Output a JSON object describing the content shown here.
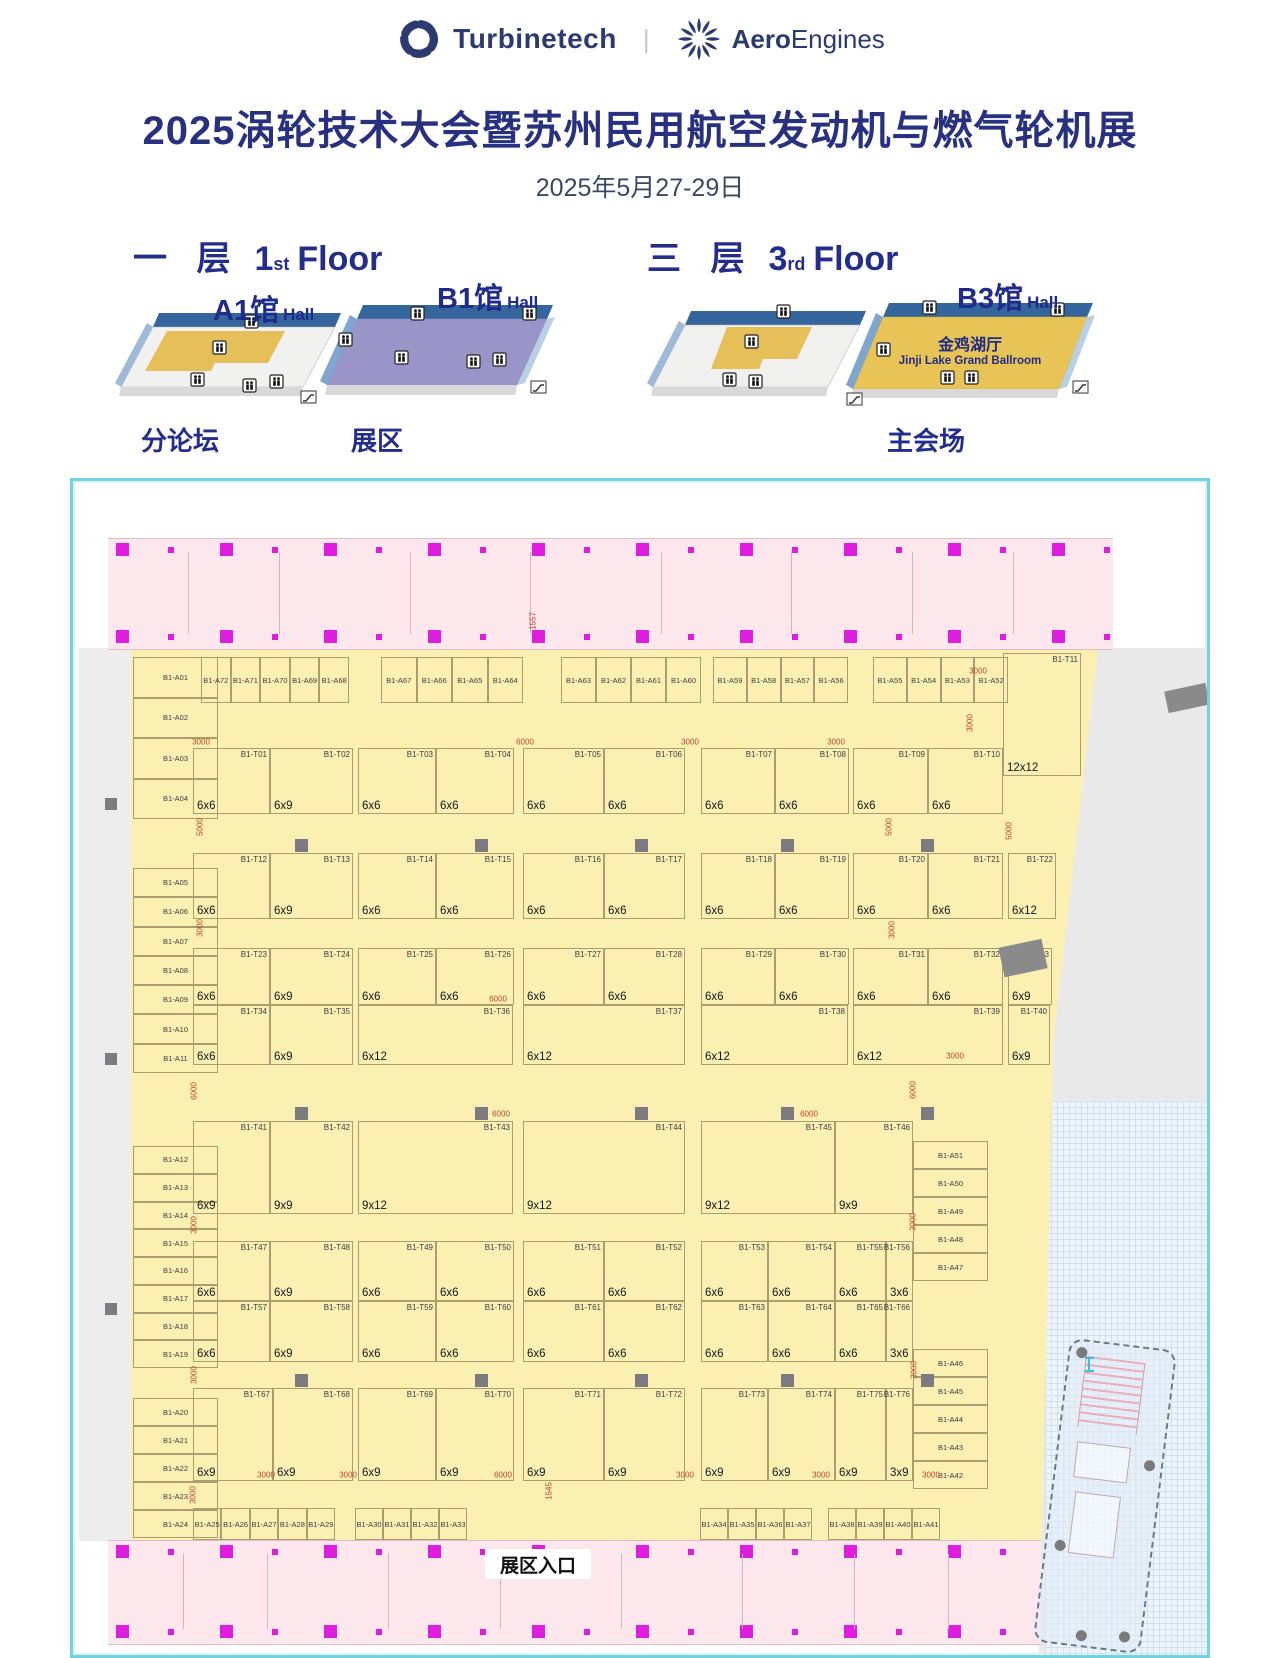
{
  "header": {
    "brand1": "Turbinetech",
    "divider": "|",
    "brand2_bold": "Aero",
    "brand2_rest": "Engines"
  },
  "title": "2025涡轮技术大会暨苏州民用航空发动机与燃气轮机展",
  "date": "2025年5月27-29日",
  "floors": {
    "first": {
      "label_zh": "一 层",
      "label_num": "1",
      "label_sup": "st",
      "label_en": "Floor",
      "hall_a": {
        "name": "A1馆",
        "suffix": "Hall"
      },
      "hall_b": {
        "name": "B1馆",
        "suffix": "Hall"
      },
      "caption_a": "分论坛",
      "caption_b": "展区"
    },
    "third": {
      "label_zh": "三 层",
      "label_num": "3",
      "label_sup": "rd",
      "label_en": "Floor",
      "hall": {
        "name": "B3馆",
        "suffix": "Hall"
      },
      "ballroom_zh": "金鸡湖厅",
      "ballroom_en": "Jinji Lake Grand Ballroom",
      "caption": "主会场"
    }
  },
  "colors": {
    "navy": "#27317f",
    "floor_yellow": "#faf0b2",
    "pink": "#fbe7ec",
    "magenta": "#df1ddf",
    "cyan": "#73d2e2",
    "gold": "#e6bf58",
    "purple": "#9a95c9",
    "red_dim": "#c0432b"
  },
  "plan": {
    "entrance": "展区入口",
    "left_column_groups": [
      [
        "B1-A01",
        "B1-A02",
        "B1-A03",
        "B1-A04"
      ],
      [
        "B1-A05",
        "B1-A06",
        "B1-A07",
        "B1-A08",
        "B1-A09",
        "B1-A10",
        "B1-A11"
      ],
      [
        "B1-A12",
        "B1-A13",
        "B1-A14",
        "B1-A15",
        "B1-A16",
        "B1-A17",
        "B1-A18",
        "B1-A19"
      ],
      [
        "B1-A20",
        "B1-A21",
        "B1-A22",
        "B1-A23",
        "B1-A24"
      ]
    ],
    "top_row_groups": [
      [
        "B1-A72",
        "B1-A71",
        "B1-A70",
        "B1-A69",
        "B1-A68"
      ],
      [
        "B1-A67",
        "B1-A66",
        "B1-A65",
        "B1-A64"
      ],
      [
        "B1-A63",
        "B1-A62",
        "B1-A61",
        "B1-A60"
      ],
      [
        "B1-A59",
        "B1-A58",
        "B1-A57",
        "B1-A56"
      ],
      [
        "B1-A55",
        "B1-A54",
        "B1-A53",
        "B1-A52"
      ]
    ],
    "right_column_groups": [
      [
        "B1-A51",
        "B1-A50",
        "B1-A49",
        "B1-A48",
        "B1-A47"
      ],
      [
        "B1-A46",
        "B1-A45",
        "B1-A44",
        "B1-A43",
        "B1-A42"
      ]
    ],
    "bottom_row_groups": [
      [
        "B1-A25",
        "B1-A26",
        "B1-A27",
        "B1-A28",
        "B1-A29"
      ],
      [
        "B1-A30",
        "B1-A31",
        "B1-A32",
        "B1-A33"
      ],
      [
        "B1-A34",
        "B1-A35",
        "B1-A36",
        "B1-A37"
      ],
      [
        "B1-A38",
        "B1-A39",
        "B1-A40",
        "B1-A41"
      ]
    ],
    "right_booths": [
      {
        "id": "B1-T11",
        "size": "12x12"
      },
      {
        "id": "B1-T22",
        "size": "6x12"
      },
      {
        "id": "B1-T33",
        "size": "6x9"
      },
      {
        "id": "B1-T40",
        "size": "6x9"
      }
    ],
    "bands": [
      {
        "blocks": [
          [
            {
              "id": "B1-T01",
              "size": "6x6",
              "w": 0.48
            },
            {
              "id": "B1-T02",
              "size": "6x9",
              "w": 0.52
            }
          ],
          [
            {
              "id": "B1-T03",
              "size": "6x6",
              "w": 0.5
            },
            {
              "id": "B1-T04",
              "size": "6x6",
              "w": 0.5
            }
          ],
          [
            {
              "id": "B1-T05",
              "size": "6x6",
              "w": 0.5
            },
            {
              "id": "B1-T06",
              "size": "6x6",
              "w": 0.5
            }
          ],
          [
            {
              "id": "B1-T07",
              "size": "6x6",
              "w": 0.5
            },
            {
              "id": "B1-T08",
              "size": "6x6",
              "w": 0.5
            }
          ],
          [
            {
              "id": "B1-T09",
              "size": "6x6",
              "w": 0.5
            },
            {
              "id": "B1-T10",
              "size": "6x6",
              "w": 0.5
            }
          ]
        ]
      },
      {
        "blocks": [
          [
            {
              "id": "B1-T12",
              "size": "6x6",
              "w": 0.48
            },
            {
              "id": "B1-T13",
              "size": "6x9",
              "w": 0.52
            }
          ],
          [
            {
              "id": "B1-T14",
              "size": "6x6",
              "w": 0.5
            },
            {
              "id": "B1-T15",
              "size": "6x6",
              "w": 0.5
            }
          ],
          [
            {
              "id": "B1-T16",
              "size": "6x6",
              "w": 0.5
            },
            {
              "id": "B1-T17",
              "size": "6x6",
              "w": 0.5
            }
          ],
          [
            {
              "id": "B1-T18",
              "size": "6x6",
              "w": 0.5
            },
            {
              "id": "B1-T19",
              "size": "6x6",
              "w": 0.5
            }
          ],
          [
            {
              "id": "B1-T20",
              "size": "6x6",
              "w": 0.5
            },
            {
              "id": "B1-T21",
              "size": "6x6",
              "w": 0.5
            }
          ]
        ]
      },
      {
        "blocks": [
          [
            {
              "id": "B1-T23",
              "size": "6x6",
              "w": 0.48
            },
            {
              "id": "B1-T24",
              "size": "6x9",
              "w": 0.52
            }
          ],
          [
            {
              "id": "B1-T25",
              "size": "6x6",
              "w": 0.5
            },
            {
              "id": "B1-T26",
              "size": "6x6",
              "w": 0.5
            }
          ],
          [
            {
              "id": "B1-T27",
              "size": "6x6",
              "w": 0.5
            },
            {
              "id": "B1-T28",
              "size": "6x6",
              "w": 0.5
            }
          ],
          [
            {
              "id": "B1-T29",
              "size": "6x6",
              "w": 0.5
            },
            {
              "id": "B1-T30",
              "size": "6x6",
              "w": 0.5
            }
          ],
          [
            {
              "id": "B1-T31",
              "size": "6x6",
              "w": 0.5
            },
            {
              "id": "B1-T32",
              "size": "6x6",
              "w": 0.5
            }
          ]
        ]
      },
      {
        "blocks": [
          [
            {
              "id": "B1-T34",
              "size": "6x6",
              "w": 0.48
            },
            {
              "id": "B1-T35",
              "size": "6x9",
              "w": 0.52
            }
          ],
          [
            {
              "id": "B1-T36",
              "size": "6x12",
              "w": 1
            }
          ],
          [
            {
              "id": "B1-T37",
              "size": "6x12",
              "w": 1
            }
          ],
          [
            {
              "id": "B1-T38",
              "size": "6x12",
              "w": 1
            }
          ],
          [
            {
              "id": "B1-T39",
              "size": "6x12",
              "w": 1
            }
          ]
        ]
      },
      {
        "blocks": [
          [
            {
              "id": "B1-T41",
              "size": "6x9",
              "w": 0.48
            },
            {
              "id": "B1-T42",
              "size": "9x9",
              "w": 0.52
            }
          ],
          [
            {
              "id": "B1-T43",
              "size": "9x12",
              "w": 1
            }
          ],
          [
            {
              "id": "B1-T44",
              "size": "9x12",
              "w": 1
            }
          ],
          [
            {
              "id": "B1-T45",
              "size": "9x12",
              "w": 1
            }
          ],
          [
            {
              "id": "B1-T46",
              "size": "9x9",
              "w": 1
            }
          ]
        ]
      },
      {
        "blocks": [
          [
            {
              "id": "B1-T47",
              "size": "6x6",
              "w": 0.48
            },
            {
              "id": "B1-T48",
              "size": "6x9",
              "w": 0.52
            }
          ],
          [
            {
              "id": "B1-T49",
              "size": "6x6",
              "w": 0.5
            },
            {
              "id": "B1-T50",
              "size": "6x6",
              "w": 0.5
            }
          ],
          [
            {
              "id": "B1-T51",
              "size": "6x6",
              "w": 0.5
            },
            {
              "id": "B1-T52",
              "size": "6x6",
              "w": 0.5
            }
          ],
          [
            {
              "id": "B1-T53",
              "size": "6x6",
              "w": 0.5
            },
            {
              "id": "B1-T54",
              "size": "6x6",
              "w": 0.5
            }
          ],
          [
            {
              "id": "B1-T55",
              "size": "6x6",
              "w": 0.66
            },
            {
              "id": "B1-T56",
              "size": "3x6",
              "w": 0.34
            }
          ]
        ]
      },
      {
        "blocks": [
          [
            {
              "id": "B1-T57",
              "size": "6x6",
              "w": 0.48
            },
            {
              "id": "B1-T58",
              "size": "6x9",
              "w": 0.52
            }
          ],
          [
            {
              "id": "B1-T59",
              "size": "6x6",
              "w": 0.5
            },
            {
              "id": "B1-T60",
              "size": "6x6",
              "w": 0.5
            }
          ],
          [
            {
              "id": "B1-T61",
              "size": "6x6",
              "w": 0.5
            },
            {
              "id": "B1-T62",
              "size": "6x6",
              "w": 0.5
            }
          ],
          [
            {
              "id": "B1-T63",
              "size": "6x6",
              "w": 0.5
            },
            {
              "id": "B1-T64",
              "size": "6x6",
              "w": 0.5
            }
          ],
          [
            {
              "id": "B1-T65",
              "size": "6x6",
              "w": 0.66
            },
            {
              "id": "B1-T66",
              "size": "3x6",
              "w": 0.34
            }
          ]
        ]
      },
      {
        "blocks": [
          [
            {
              "id": "B1-T67",
              "size": "6x9",
              "w": 0.5
            },
            {
              "id": "B1-T68",
              "size": "6x9",
              "w": 0.5
            }
          ],
          [
            {
              "id": "B1-T69",
              "size": "6x9",
              "w": 0.5
            },
            {
              "id": "B1-T70",
              "size": "6x9",
              "w": 0.5
            }
          ],
          [
            {
              "id": "B1-T71",
              "size": "6x9",
              "w": 0.5
            },
            {
              "id": "B1-T72",
              "size": "6x9",
              "w": 0.5
            }
          ],
          [
            {
              "id": "B1-T73",
              "size": "6x9",
              "w": 0.5
            },
            {
              "id": "B1-T74",
              "size": "6x9",
              "w": 0.5
            }
          ],
          [
            {
              "id": "B1-T75",
              "size": "6x9",
              "w": 0.66
            },
            {
              "id": "B1-T76",
              "size": "3x9",
              "w": 0.34
            }
          ]
        ]
      }
    ],
    "dims": [
      {
        "v": "1557",
        "x": 460,
        "y": 140,
        "r": 1
      },
      {
        "v": "3000",
        "x": 905,
        "y": 190,
        "r": 0
      },
      {
        "v": "3000",
        "x": 897,
        "y": 242,
        "r": 1
      },
      {
        "v": "3000",
        "x": 128,
        "y": 261,
        "r": 0
      },
      {
        "v": "6000",
        "x": 452,
        "y": 261,
        "r": 0
      },
      {
        "v": "3000",
        "x": 617,
        "y": 261,
        "r": 0
      },
      {
        "v": "3000",
        "x": 763,
        "y": 261,
        "r": 0
      },
      {
        "v": "5000",
        "x": 127,
        "y": 346,
        "r": 1
      },
      {
        "v": "5000",
        "x": 816,
        "y": 346,
        "r": 1
      },
      {
        "v": "5000",
        "x": 936,
        "y": 350,
        "r": 1
      },
      {
        "v": "3000",
        "x": 127,
        "y": 447,
        "r": 1
      },
      {
        "v": "3000",
        "x": 819,
        "y": 449,
        "r": 1
      },
      {
        "v": "6000",
        "x": 425,
        "y": 518,
        "r": 0
      },
      {
        "v": "3000",
        "x": 882,
        "y": 575,
        "r": 0
      },
      {
        "v": "6000",
        "x": 121,
        "y": 610,
        "r": 1
      },
      {
        "v": "6000",
        "x": 840,
        "y": 609,
        "r": 1
      },
      {
        "v": "6000",
        "x": 428,
        "y": 633,
        "r": 0
      },
      {
        "v": "6000",
        "x": 736,
        "y": 633,
        "r": 0
      },
      {
        "v": "3000",
        "x": 121,
        "y": 744,
        "r": 1
      },
      {
        "v": "3000",
        "x": 840,
        "y": 741,
        "r": 1
      },
      {
        "v": "3000",
        "x": 121,
        "y": 894,
        "r": 1
      },
      {
        "v": "3000",
        "x": 841,
        "y": 889,
        "r": 1
      },
      {
        "v": "3000",
        "x": 193,
        "y": 994,
        "r": 0
      },
      {
        "v": "3000",
        "x": 275,
        "y": 994,
        "r": 0
      },
      {
        "v": "6000",
        "x": 430,
        "y": 994,
        "r": 0
      },
      {
        "v": "3000",
        "x": 612,
        "y": 994,
        "r": 0
      },
      {
        "v": "3000",
        "x": 748,
        "y": 994,
        "r": 0
      },
      {
        "v": "3000",
        "x": 858,
        "y": 994,
        "r": 0
      },
      {
        "v": "1545",
        "x": 476,
        "y": 1010,
        "r": 1
      },
      {
        "v": "3000",
        "x": 120,
        "y": 1014,
        "r": 1
      }
    ]
  }
}
